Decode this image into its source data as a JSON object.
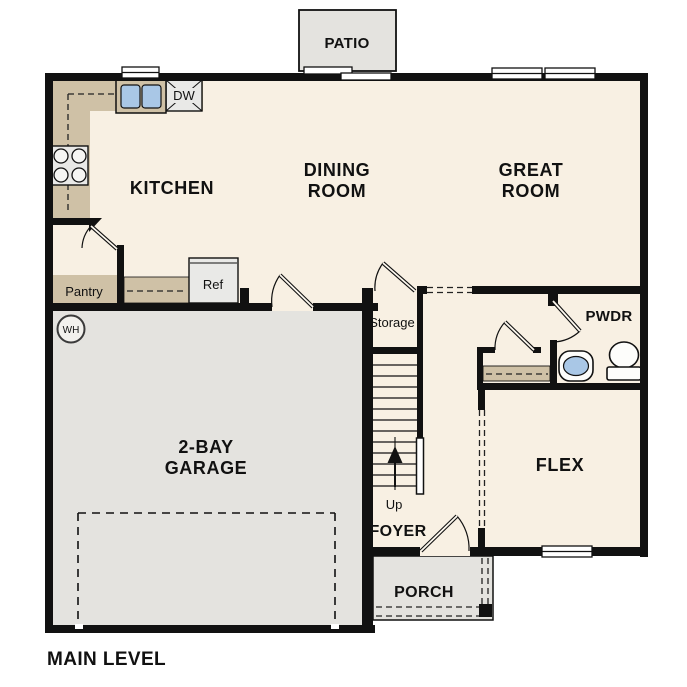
{
  "floorplan": {
    "title": "MAIN LEVEL",
    "labels": {
      "patio": "PATIO",
      "kitchen": "KITCHEN",
      "dining_room": [
        "DINING",
        "ROOM"
      ],
      "great_room": [
        "GREAT",
        "ROOM"
      ],
      "garage": [
        "2-BAY",
        "GARAGE"
      ],
      "flex": "FLEX",
      "foyer": "FOYER",
      "porch": "PORCH",
      "pwdr": "PWDR",
      "storage": "Storage",
      "pantry": "Pantry",
      "ref": "Ref",
      "dw": "DW",
      "wh": "WH",
      "up": "Up"
    },
    "colors": {
      "wall": "#111111",
      "floor": "#f8f0e3",
      "gray_area": "#e4e3df",
      "counter_tan": "#cfc1a6",
      "appliance_gray": "#e9e9e7",
      "sink_blue": "#a9c7e6",
      "white_fixture": "#fdfdfb"
    }
  }
}
